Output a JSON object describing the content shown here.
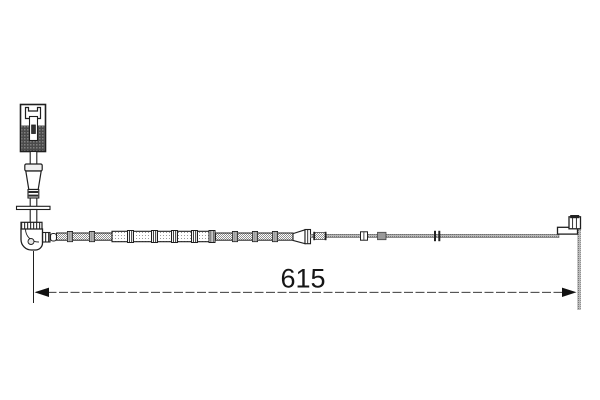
{
  "drawing": {
    "kind": "technical line drawing of a cable sensor part with length dimension",
    "dimension_label": "615",
    "line_color": "#1f1f1f",
    "cable_gray": "#8f8f8f",
    "background": "#ffffff",
    "parts": [
      "electrical-connector",
      "cable-grommet",
      "strain-relief-boot",
      "mounting-washer",
      "elbow-boot",
      "clipped-sleeve-cable",
      "transition-cone",
      "wire-lead",
      "sensor-end-bracket",
      "dimension-line"
    ]
  }
}
